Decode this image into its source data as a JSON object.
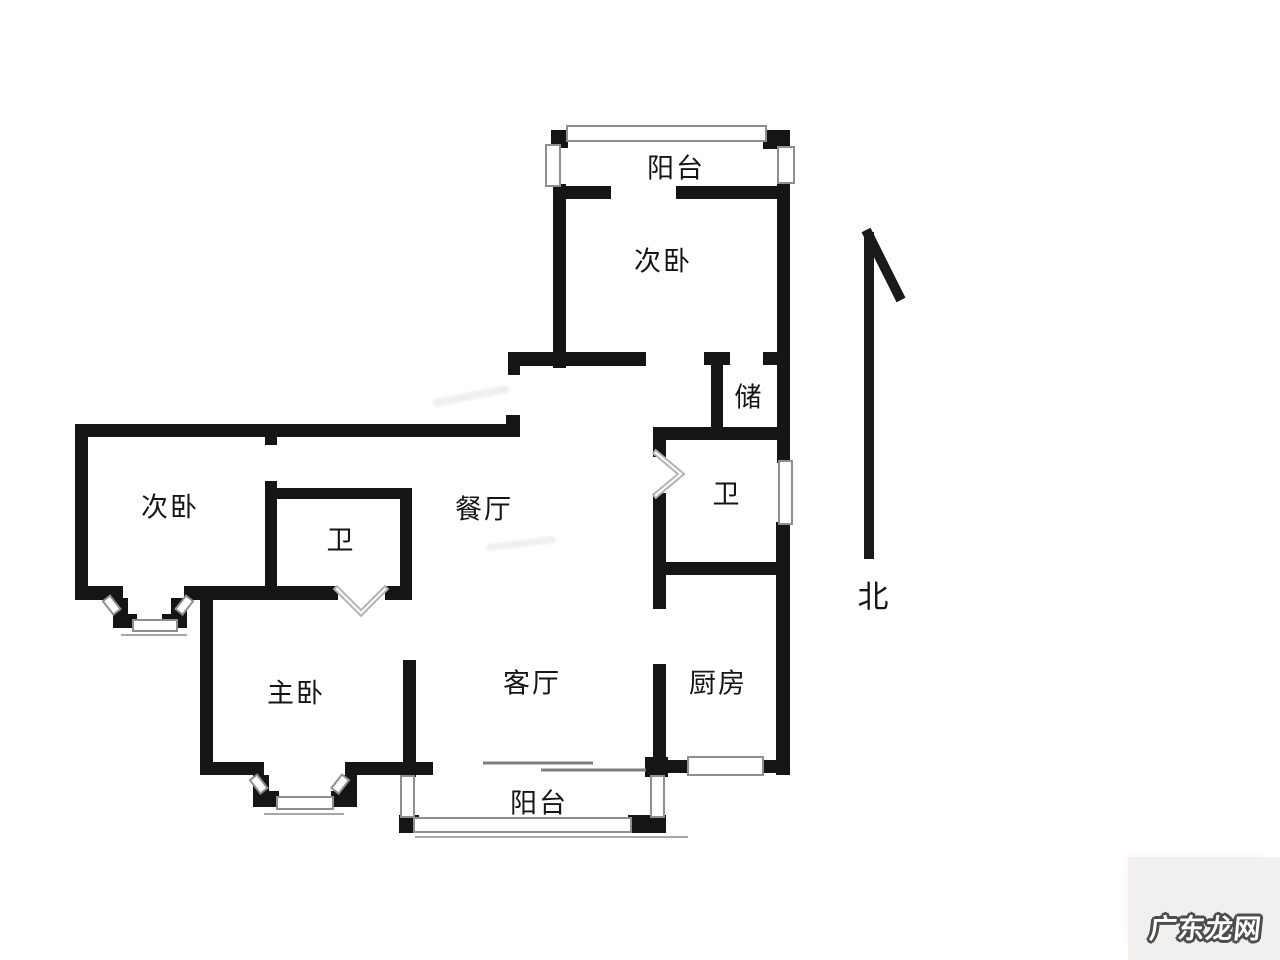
{
  "rooms": {
    "balcony_top": {
      "label": "阳台"
    },
    "bedroom_top": {
      "label": "次卧"
    },
    "storage": {
      "label": "储"
    },
    "bath_right": {
      "label": "卫"
    },
    "dining": {
      "label": "餐厅"
    },
    "bedroom_left": {
      "label": "次卧"
    },
    "bath_left": {
      "label": "卫"
    },
    "master_bedroom": {
      "label": "主卧"
    },
    "living": {
      "label": "客厅"
    },
    "kitchen": {
      "label": "厨房"
    },
    "balcony_bottom": {
      "label": "阳台"
    }
  },
  "compass": {
    "label": "北"
  },
  "watermark": {
    "text": "广东龙网"
  },
  "colors": {
    "wall": "#151515",
    "window_border": "#8f8f8f",
    "door_swing": "#b3b3b3",
    "label_text": "#151515",
    "watermark_bg": "#f1f0ee",
    "watermark_outline": "#4d4d4d"
  }
}
